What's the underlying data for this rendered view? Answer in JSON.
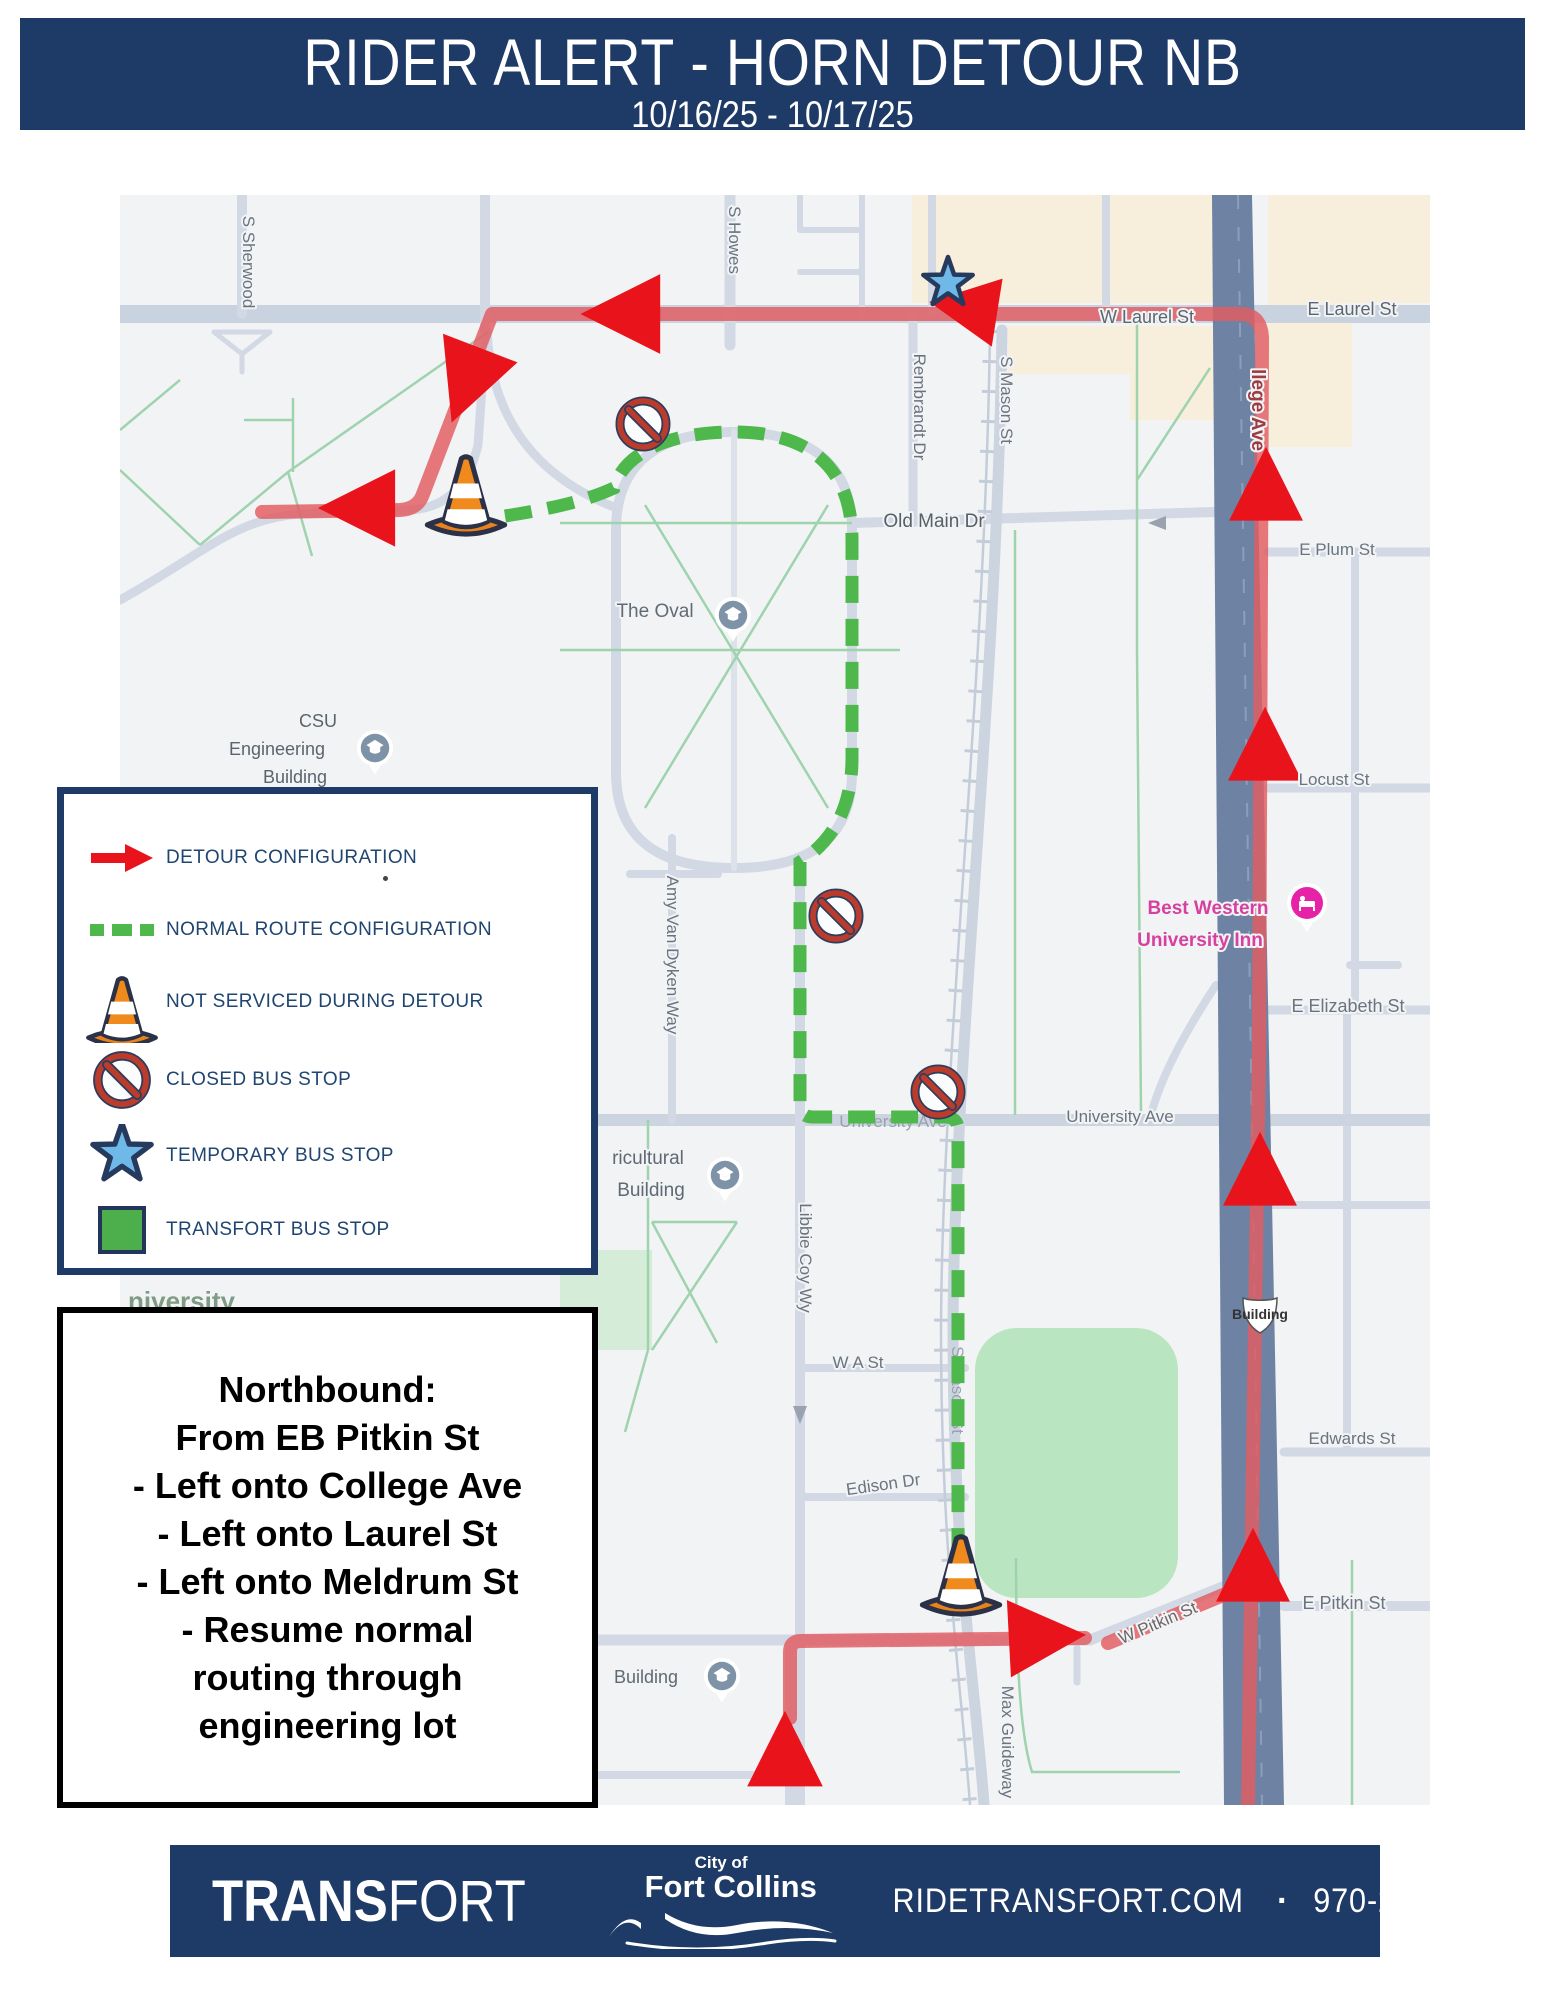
{
  "header": {
    "title": "RIDER ALERT - HORN DETOUR NB",
    "dates": "10/16/25 - 10/17/25"
  },
  "legend": {
    "items": [
      {
        "icon": "detour-arrow-icon",
        "label": "DETOUR CONFIGURATION"
      },
      {
        "icon": "dashed-route-icon",
        "label": "NORMAL ROUTE CONFIGURATION"
      },
      {
        "icon": "cone-icon",
        "label": "NOT SERVICED DURING DETOUR"
      },
      {
        "icon": "closed-stop-icon",
        "label": "CLOSED BUS STOP"
      },
      {
        "icon": "temporary-stop-star-icon",
        "label": "TEMPORARY BUS STOP"
      },
      {
        "icon": "bus-stop-square-icon",
        "label": "TRANSFORT BUS STOP"
      }
    ]
  },
  "directions": {
    "lines": [
      "Northbound:",
      "From EB Pitkin St",
      "- Left onto College Ave",
      "- Left onto Laurel St",
      "- Left onto Meldrum St",
      "- Resume normal",
      "routing through",
      "engineering lot"
    ]
  },
  "map": {
    "labels": [
      {
        "text": "S Sherwood"
      },
      {
        "text": "S Howes"
      },
      {
        "text": "Rembrandt Dr"
      },
      {
        "text": "S Mason St"
      },
      {
        "text": "W Laurel St"
      },
      {
        "text": "E Laurel St"
      },
      {
        "text": "llege Ave"
      },
      {
        "text": "E Plum St"
      },
      {
        "text": "Old Main Dr"
      },
      {
        "text": "The Oval"
      },
      {
        "text": "Locust St"
      },
      {
        "text": "CSU"
      },
      {
        "text": "Engineering"
      },
      {
        "text": "Building"
      },
      {
        "text": "Best Western"
      },
      {
        "text": "University Inn"
      },
      {
        "text": "E Elizabeth St"
      },
      {
        "text": "Amy Van Dyken Way"
      },
      {
        "text": "University Ave"
      },
      {
        "text": "University Ave"
      },
      {
        "text": "ricultural"
      },
      {
        "text": "Building"
      },
      {
        "text": "niversity"
      },
      {
        "text": "Libbie Coy Wy"
      },
      {
        "text": "W A St"
      },
      {
        "text": "Edison Dr"
      },
      {
        "text": "Edwards St"
      },
      {
        "text": "E Pitkin St"
      },
      {
        "text": "W Pitkin St"
      },
      {
        "text": "Max Guideway"
      },
      {
        "text": "S Mason St"
      },
      {
        "text": "Building"
      },
      {
        "text": "287"
      }
    ],
    "colors": {
      "navy": "#1e3a67",
      "detour_arrow_red": "#e8131b",
      "route_red": "#e25c60",
      "normal_route_green": "#4eb84c",
      "map_background": "#f2f3f5",
      "temporary_stop_blue": "#6fb9e9",
      "poi_pink": "#e623a7"
    }
  },
  "footer": {
    "brand_bold": "TRANS",
    "brand_light": "FORT",
    "city_top": "City of",
    "city_name": "Fort Collins",
    "site": "RIDETRANSFORT.COM",
    "separator": "·",
    "phone": "970-221-6620"
  }
}
